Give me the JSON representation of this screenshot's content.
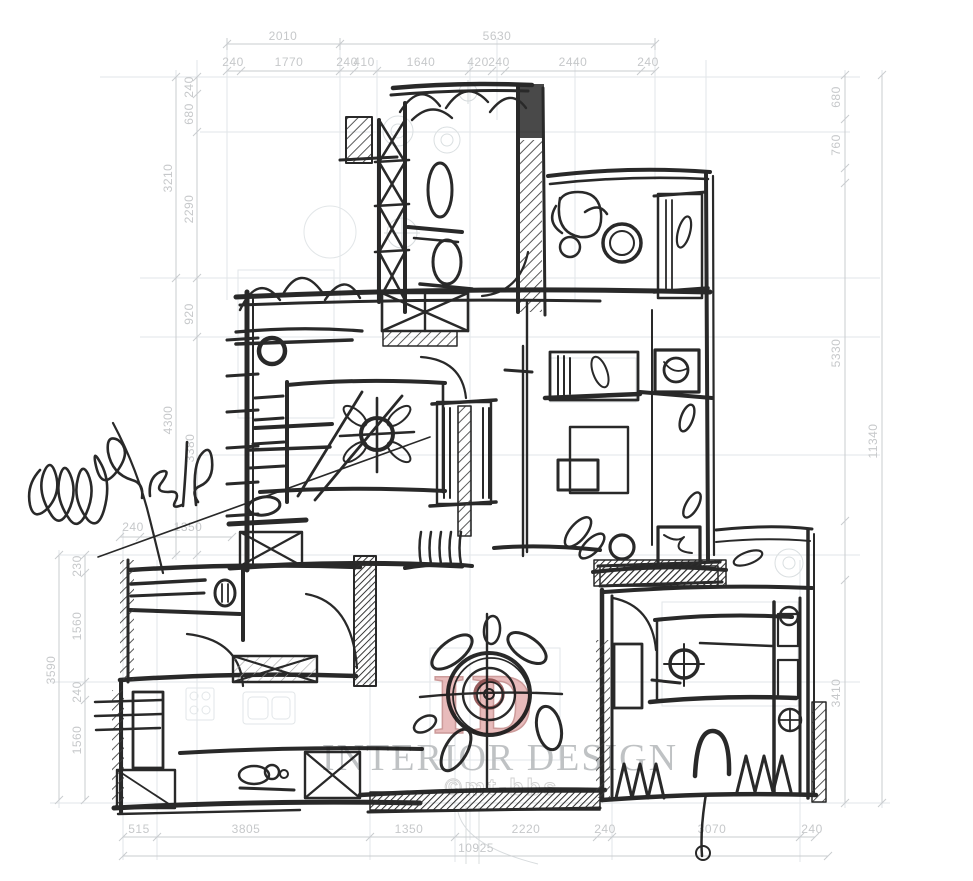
{
  "page": {
    "background": "#ffffff",
    "description": "hand-drawn apartment floor plan sketch over faint CAD underlay"
  },
  "watermark": {
    "logo_text": "ID",
    "title": "INTERIOR DESIGN",
    "subtitle": "©mt-bbs",
    "logo_color": "#e3abab",
    "title_color": "#b5b8ba"
  },
  "signature": {
    "present": true,
    "year_scribble": "2016"
  },
  "colors": {
    "sketch_ink": "#161616",
    "dimension_text": "#c6c8ca",
    "cad_underlay": "#e2e6e8",
    "table_ring_red": "#8d4f4f"
  },
  "dimensions": {
    "top_row1": [
      "2010",
      "5630"
    ],
    "top_row2": [
      "240",
      "1770",
      "240",
      "410",
      "1640",
      "420",
      "240",
      "2440",
      "240"
    ],
    "left_outer": [
      "3210",
      "4300"
    ],
    "left_inner": [
      "240",
      "680",
      "2290",
      "920",
      "3380"
    ],
    "left_lower_outer": [
      "3590"
    ],
    "left_lower_inner": [
      "230",
      "1560",
      "240",
      "1560"
    ],
    "mid_left_horizontal": [
      "240",
      "1350"
    ],
    "right_inner": [
      "680",
      "760",
      "5330",
      "3410"
    ],
    "right_outer": [
      "11340"
    ],
    "bottom_row1": [
      "515",
      "3805",
      "1350",
      "2220",
      "240",
      "3070",
      "240"
    ],
    "bottom_row2": [
      "10925"
    ]
  }
}
